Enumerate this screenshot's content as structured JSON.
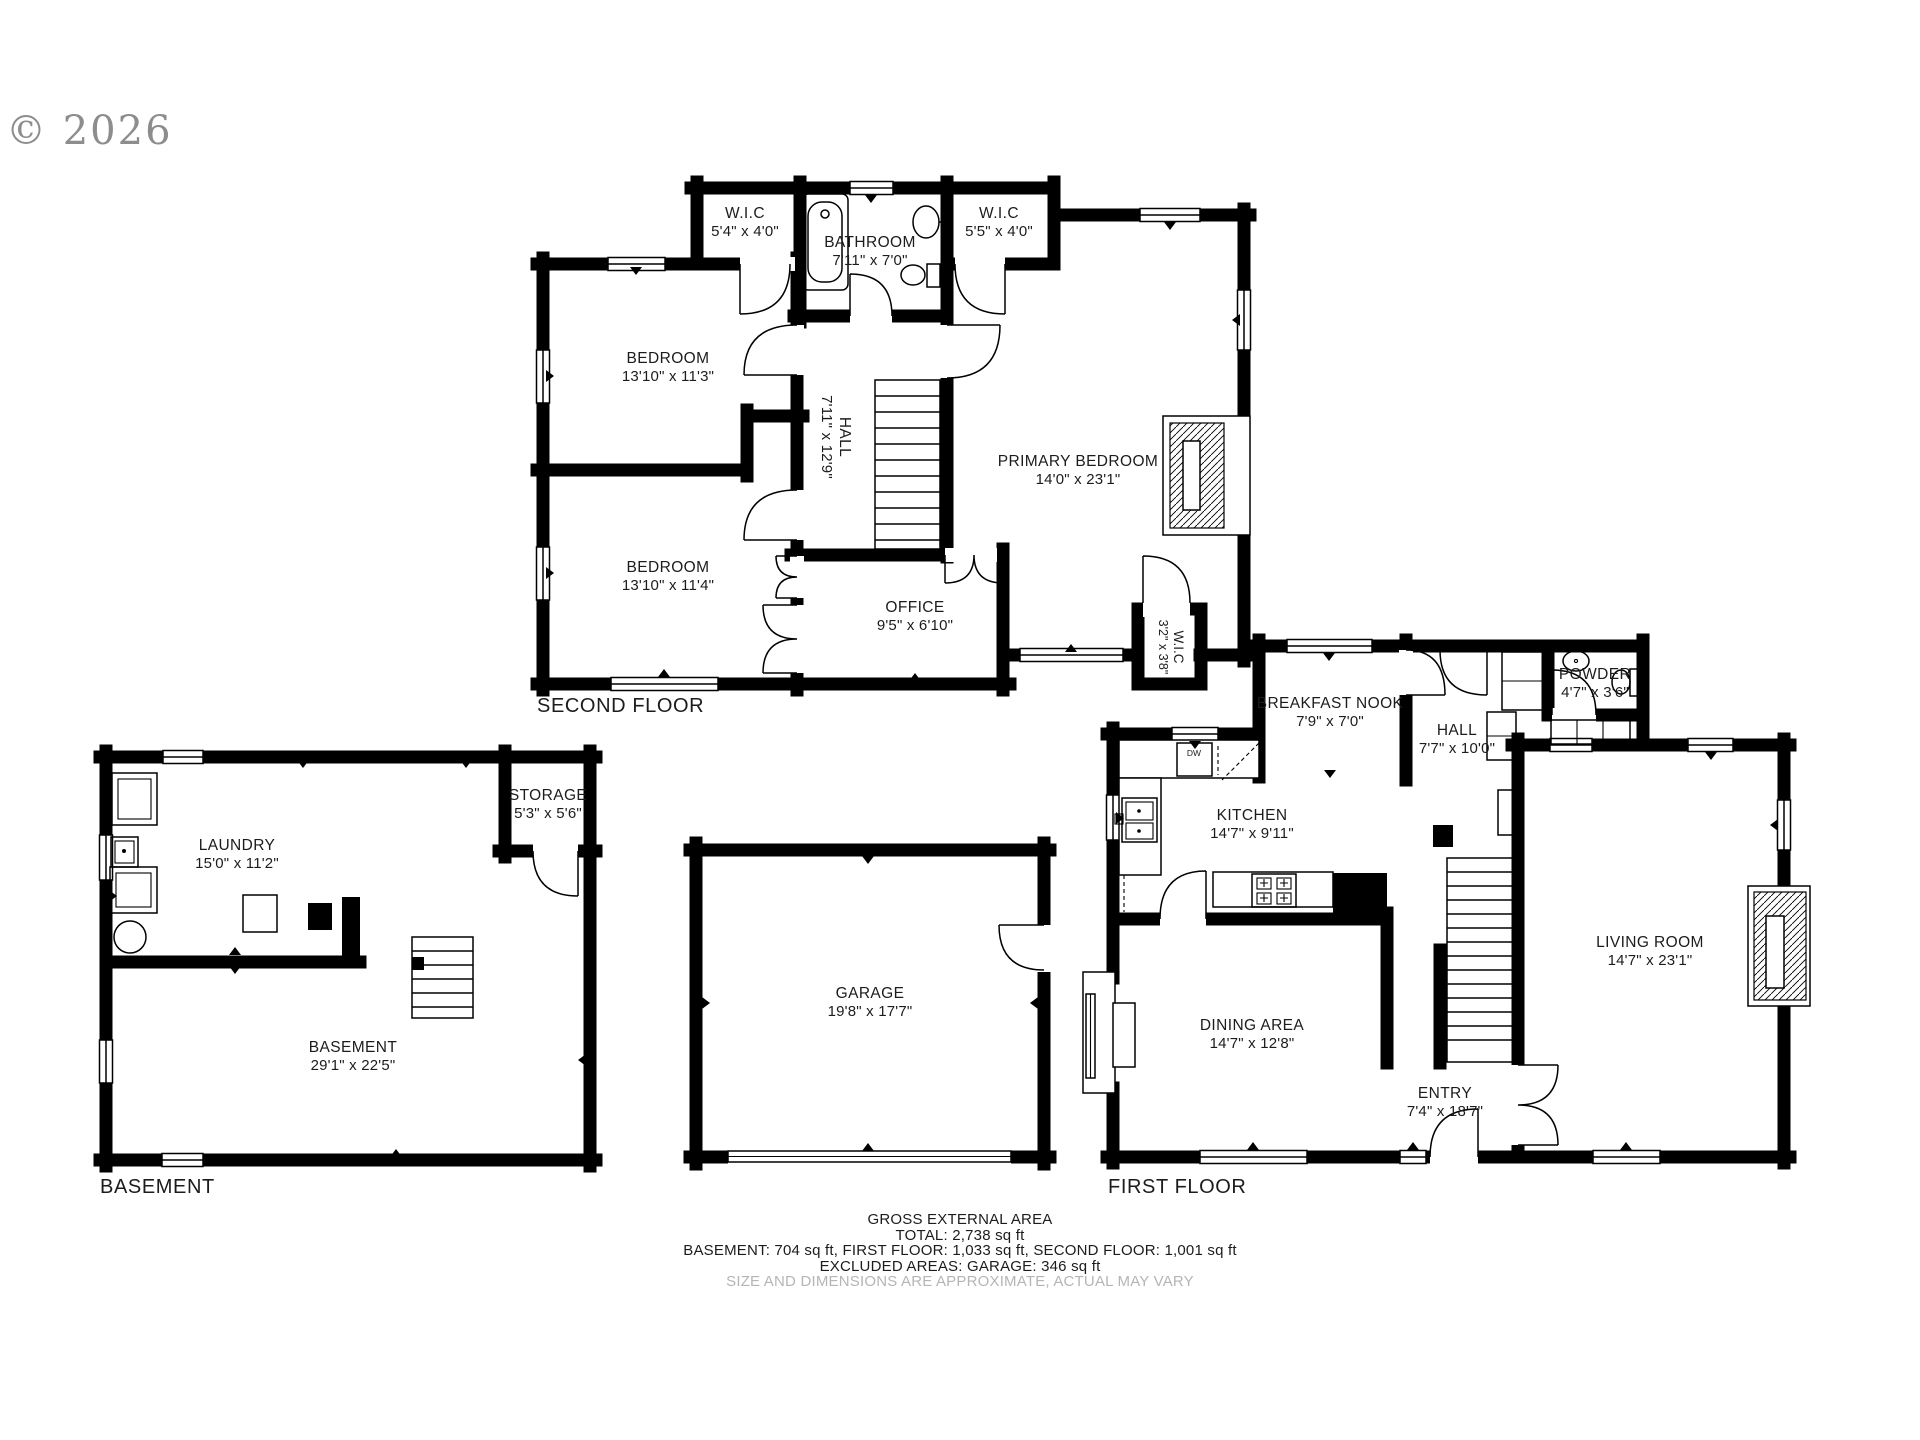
{
  "meta": {
    "copyright": "© 2026"
  },
  "colors": {
    "wall": "#000000",
    "text": "#1c1c1c",
    "muted_text": "#b5b5b5",
    "copyright": "#8d8d8d",
    "background": "#ffffff"
  },
  "floors": {
    "second": {
      "label": "SECOND FLOOR",
      "rooms": {
        "wic_left": {
          "name": "W.I.C",
          "dims": "5'4\" x 4'0\""
        },
        "bathroom": {
          "name": "BATHROOM",
          "dims": "7'11\" x 7'0\""
        },
        "wic_right": {
          "name": "W.I.C",
          "dims": "5'5\" x 4'0\""
        },
        "bedroom1": {
          "name": "BEDROOM",
          "dims": "13'10\" x 11'3\""
        },
        "hall": {
          "name": "HALL",
          "dims": "7'11\" x 12'9\""
        },
        "primary": {
          "name": "PRIMARY BEDROOM",
          "dims": "14'0\" x 23'1\""
        },
        "bedroom2": {
          "name": "BEDROOM",
          "dims": "13'10\" x 11'4\""
        },
        "office": {
          "name": "OFFICE",
          "dims": "9'5\" x 6'10\""
        },
        "wic_small": {
          "name": "W.I.C",
          "dims": "3'2\" x 3'8\""
        }
      }
    },
    "first": {
      "label": "FIRST FLOOR",
      "rooms": {
        "nook": {
          "name": "BREAKFAST NOOK",
          "dims": "7'9\" x 7'0\""
        },
        "hall": {
          "name": "HALL",
          "dims": "7'7\" x 10'0\""
        },
        "powder": {
          "name": "POWDER",
          "dims": "4'7\" x 3'6\""
        },
        "kitchen": {
          "name": "KITCHEN",
          "dims": "14'7\" x 9'11\""
        },
        "living": {
          "name": "LIVING ROOM",
          "dims": "14'7\" x 23'1\""
        },
        "dining": {
          "name": "DINING AREA",
          "dims": "14'7\" x 12'8\""
        },
        "entry": {
          "name": "ENTRY",
          "dims": "7'4\" x 18'7\""
        },
        "dw": "DW"
      }
    },
    "basement": {
      "label": "BASEMENT",
      "rooms": {
        "laundry": {
          "name": "LAUNDRY",
          "dims": "15'0\" x 11'2\""
        },
        "storage": {
          "name": "STORAGE",
          "dims": "5'3\" x 5'6\""
        },
        "main": {
          "name": "BASEMENT",
          "dims": "29'1\" x 22'5\""
        }
      }
    },
    "garage": {
      "rooms": {
        "garage": {
          "name": "GARAGE",
          "dims": "19'8\" x 17'7\""
        }
      }
    }
  },
  "footer": {
    "l1": "GROSS EXTERNAL AREA",
    "l2": "TOTAL: 2,738 sq ft",
    "l3": "BASEMENT: 704 sq ft, FIRST FLOOR: 1,033 sq ft, SECOND FLOOR: 1,001 sq ft",
    "l4": "EXCLUDED AREAS: GARAGE: 346 sq ft",
    "l5": "SIZE AND DIMENSIONS ARE APPROXIMATE, ACTUAL MAY VARY"
  }
}
